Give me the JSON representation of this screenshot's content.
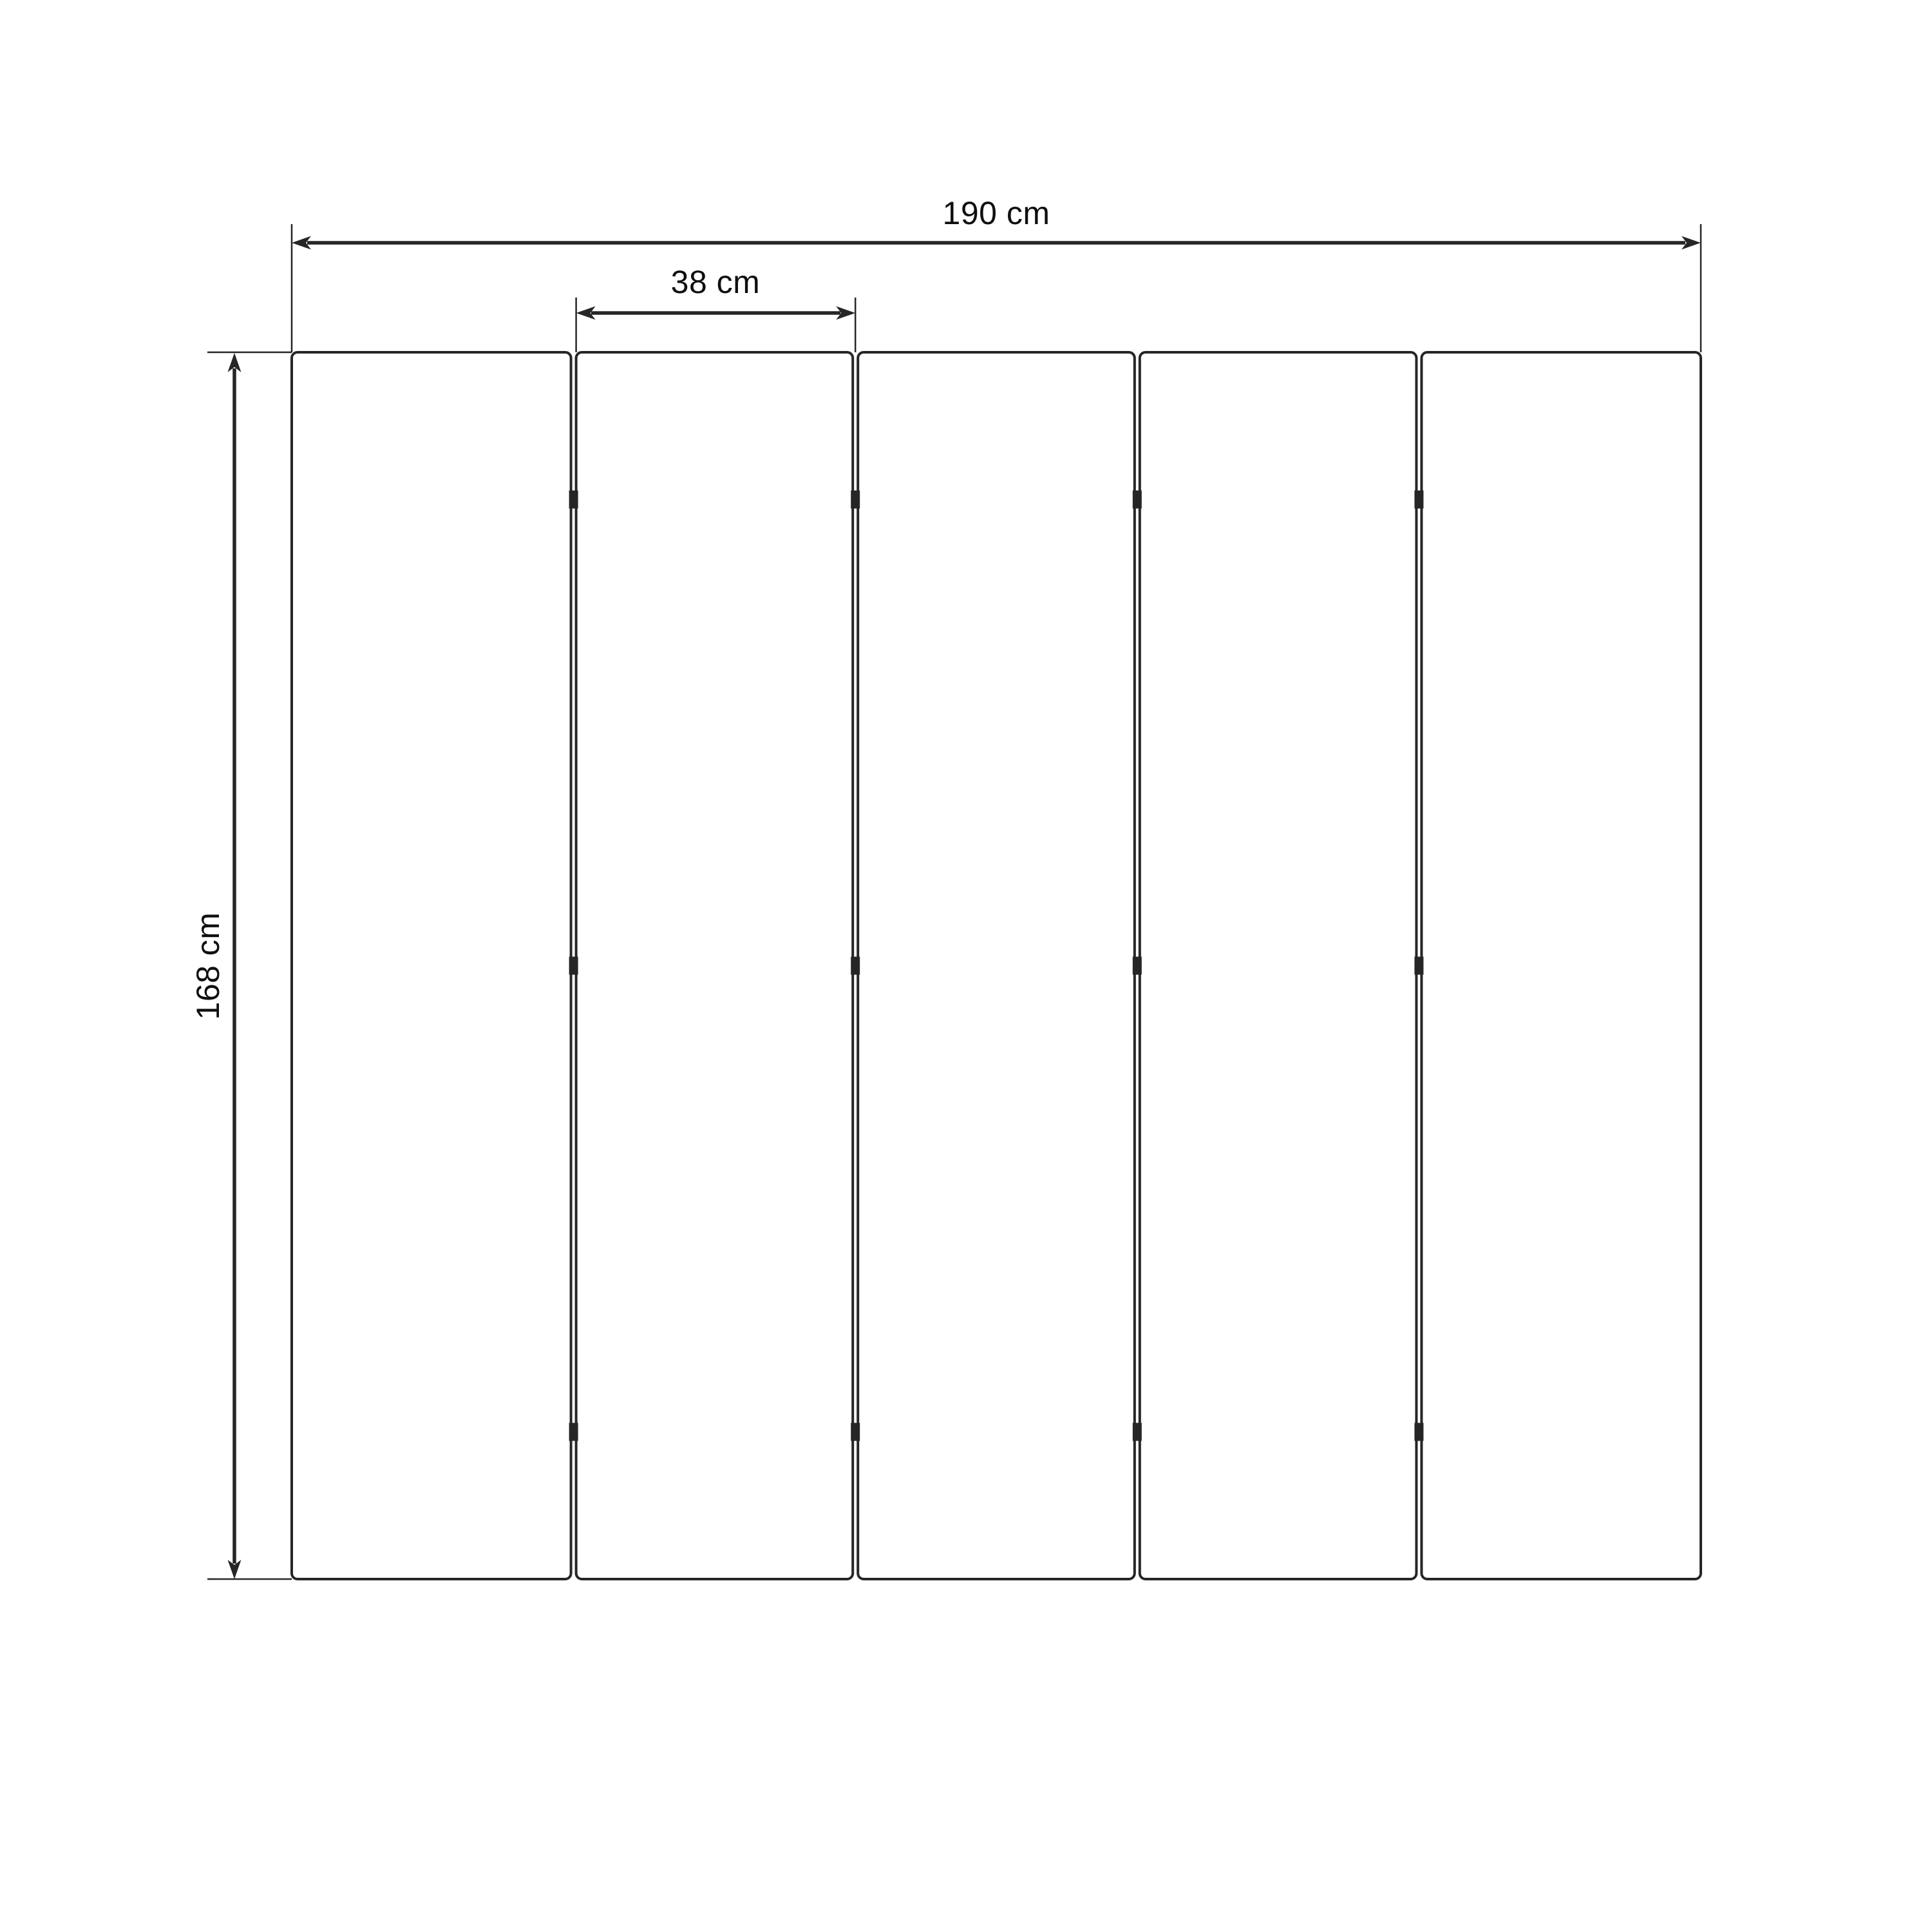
{
  "diagram": {
    "type": "technical-drawing",
    "subject": "five-panel folding screen room divider, front elevation with dimensions",
    "background_color": "#ffffff",
    "line_color": "#262626",
    "text_color": "#0f0f0f",
    "panel_count": 5,
    "gap_count": 4,
    "hinges_per_gap": 3,
    "dimensions": {
      "total_width": {
        "label": "190 cm",
        "value": 190,
        "unit": "cm"
      },
      "panel_width": {
        "label": "38 cm",
        "value": 38,
        "unit": "cm"
      },
      "height": {
        "label": "168 cm",
        "value": 168,
        "unit": "cm"
      }
    }
  }
}
